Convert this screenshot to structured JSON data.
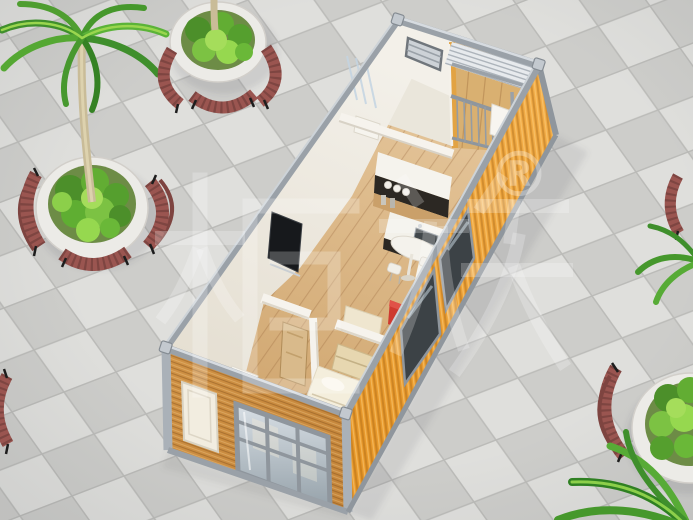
{
  "image": {
    "width": 693,
    "height": 520,
    "kind": "3d-architectural-render",
    "description": "Isometric 3D render of a prefab flat-pack container house with an open-top interior view, standing on a gray checkered tile plaza with round planters, curved wooden benches and palm trees"
  },
  "watermark": {
    "brand_text": "柜族",
    "registered_mark": "®",
    "color": "#ffffff"
  },
  "palette": {
    "tile_light": "#dfdfdc",
    "tile_dark": "#cdcdca",
    "tile_grout": "#bbbbb8",
    "container_orange": "#e8992b",
    "container_orange_light": "#f3ae49",
    "container_orange_dark": "#c87e1f",
    "frame_silver": "#9aa1a8",
    "frame_silver_light": "#d6dbe0",
    "interior_wall": "#f4f1ea",
    "interior_wall_shade": "#ddd7ca",
    "wood_floor": "#dcb98c",
    "front_wood": "#d09245",
    "bench_red": "#9a5550",
    "bench_red_dark": "#7e4440",
    "foliage_green": "#5aae33",
    "planter_white": "#ecebe7",
    "kitchen_dark": "#2c2823",
    "bed_cream": "#f4eedc",
    "tv_black": "#17191c",
    "accent_red": "#ce3a30"
  },
  "scene": {
    "house": {
      "name": "container-house",
      "rooms": [
        "bathroom",
        "balcony",
        "kitchen",
        "living-area",
        "entry-corridor",
        "bedroom"
      ],
      "furniture": [
        "wall-tv",
        "kitchen-cabinets",
        "sink",
        "dining-table",
        "stools",
        "red-mini-cabinet",
        "desk",
        "bed",
        "headboard-shelf",
        "white-cabinet",
        "interior-wood-door",
        "washer-cabinet"
      ],
      "exterior": [
        "corrugated-side-wall",
        "side-glass-windows",
        "wood-slat-end-wall",
        "white-entrance-door",
        "paned-end-window",
        "steel-roof-frame",
        "louvered-balcony-roof",
        "balcony-railing"
      ]
    },
    "plaza": {
      "planters": [
        {
          "name": "planter-top-left",
          "palm_tree": true,
          "benches": 3
        },
        {
          "name": "planter-top-center",
          "palm_tree": true,
          "benches": 3
        },
        {
          "name": "planter-bottom-right",
          "palm_tree": true,
          "benches": 1
        },
        {
          "name": "planter-right-edge",
          "palm_tree": true,
          "benches": 1
        },
        {
          "name": "planter-left-edge",
          "palm_tree": false,
          "benches": 1
        }
      ]
    }
  }
}
